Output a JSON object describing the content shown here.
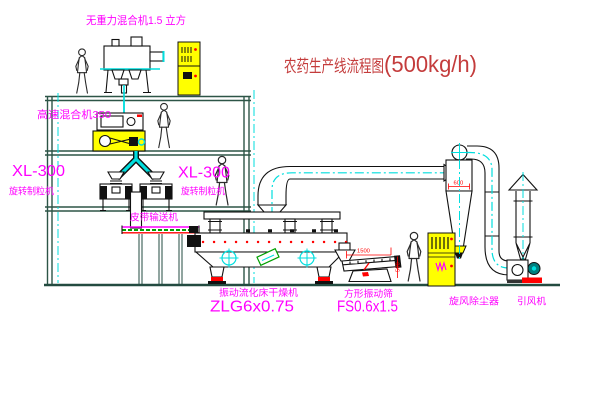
{
  "title": {
    "cn": "农药生产线流程图",
    "rate": "(500kg/h)"
  },
  "labels": {
    "gravity_mixer": "无重力混合机1.5 立方",
    "high_speed_mixer": "高速混合机350",
    "granulator_left_model": "XL-300",
    "granulator_left_name": "旋转制粒机",
    "granulator_center_model": "XL-300",
    "granulator_center_name": "旋转制粒机",
    "belt_conveyor": "皮带输送机",
    "fluid_bed_dryer_name": "振动流化床干燥机",
    "fluid_bed_dryer_model": "ZLG6x0.75",
    "vibrating_sieve_name": "方形振动筛",
    "vibrating_sieve_model": "FS0.6x1.5",
    "cyclone_name": "旋风除尘器",
    "induced_fan_name": "引风机"
  },
  "dimensions": {
    "sieve_length": "1500",
    "sieve_height": "500",
    "cyclone_outlet": "600"
  },
  "colors": {
    "label_magenta": "#ff00ff",
    "title_red": "#c43c3c",
    "dimension_red": "#ff0000",
    "structure_green": "#2d5547",
    "centerline_cyan": "#00dede",
    "cabinet_yellow": "#ffff00",
    "equipment_black": "#111111",
    "belt_green": "#00a000",
    "motor_teal": "#007f7f"
  }
}
